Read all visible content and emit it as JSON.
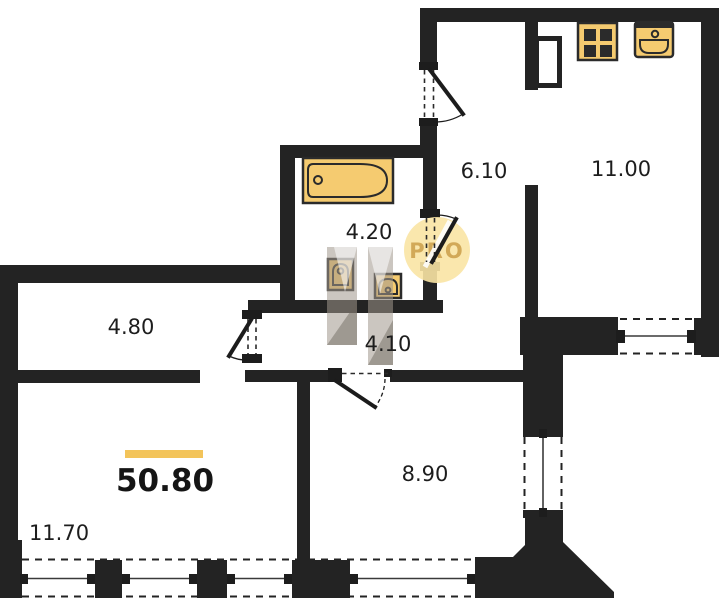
{
  "plan": {
    "title": "apartment-floor-plan",
    "total_area": "50.80",
    "watermark": "PRO",
    "rooms": [
      {
        "name": "hallway-left",
        "area": "4.80"
      },
      {
        "name": "bathroom",
        "area": "4.20"
      },
      {
        "name": "entrance-hall",
        "area": "6.10"
      },
      {
        "name": "kitchen",
        "area": "11.00"
      },
      {
        "name": "corridor",
        "area": "4.10"
      },
      {
        "name": "bedroom",
        "area": "8.90"
      },
      {
        "name": "living-room",
        "area": "11.70"
      }
    ],
    "icons": [
      "stove-icon",
      "kitchen-sink-icon",
      "bathtub-icon",
      "toilet-icon",
      "washbasin-icon"
    ],
    "colors": {
      "wall": "#232323",
      "fixture_fill": "#f5cb70",
      "fixture_outline": "#2b2b2b",
      "accent_bar": "#f3c45a",
      "watermark_circle": "#fae4a4",
      "watermark_text": "#d2a958"
    }
  }
}
